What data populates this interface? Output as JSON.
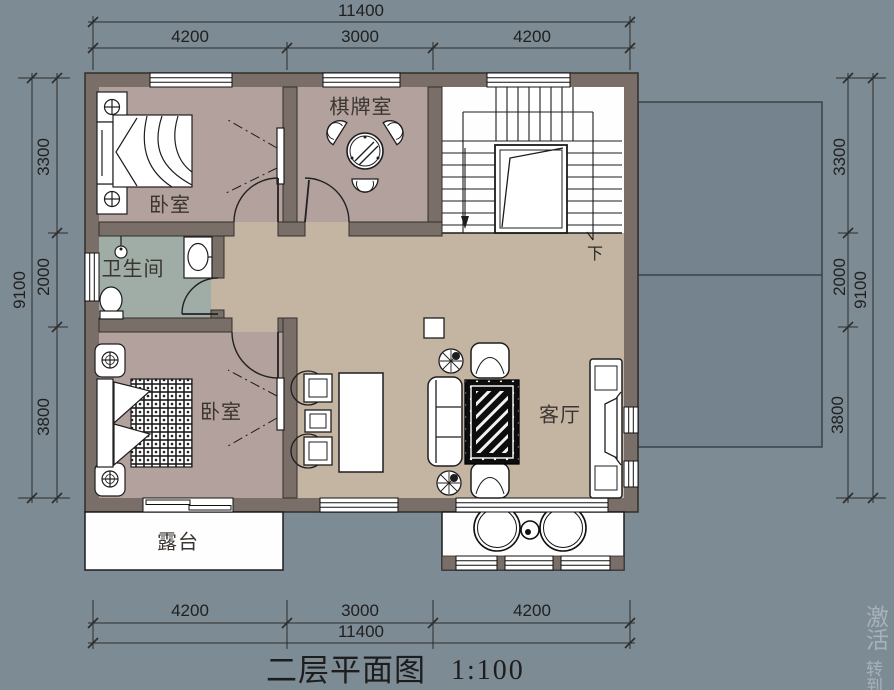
{
  "title": {
    "text": "二层平面图",
    "scale": "1:100"
  },
  "rooms": {
    "bedroom_top": "卧室",
    "chess_room": "棋牌室",
    "bathroom": "卫生间",
    "bedroom_bottom": "卧室",
    "living_room": "客厅",
    "terrace": "露台"
  },
  "stairs": {
    "down_label": "下"
  },
  "dimensions": {
    "top": {
      "overall": "11400",
      "segments": [
        "4200",
        "3000",
        "4200"
      ]
    },
    "bottom": {
      "overall": "11400",
      "segments": [
        "4200",
        "3000",
        "4200"
      ]
    },
    "left": {
      "overall": "9100",
      "segments": [
        "3300",
        "2000",
        "3800"
      ]
    },
    "right": {
      "overall": "9100",
      "segments": [
        "3300",
        "2000",
        "3800"
      ]
    }
  },
  "watermark": {
    "line1": "激活",
    "line2": "转到"
  },
  "colors": {
    "background": "#7d8b95",
    "roof_outline_fill": "#75838e",
    "wall": "#7a6f68",
    "bedroom_floor": "#b2a19c",
    "bathroom_floor": "#a0ada6",
    "hall_floor": "#c4b5a2",
    "white_floor": "#fefefe",
    "line": "#26231f"
  }
}
